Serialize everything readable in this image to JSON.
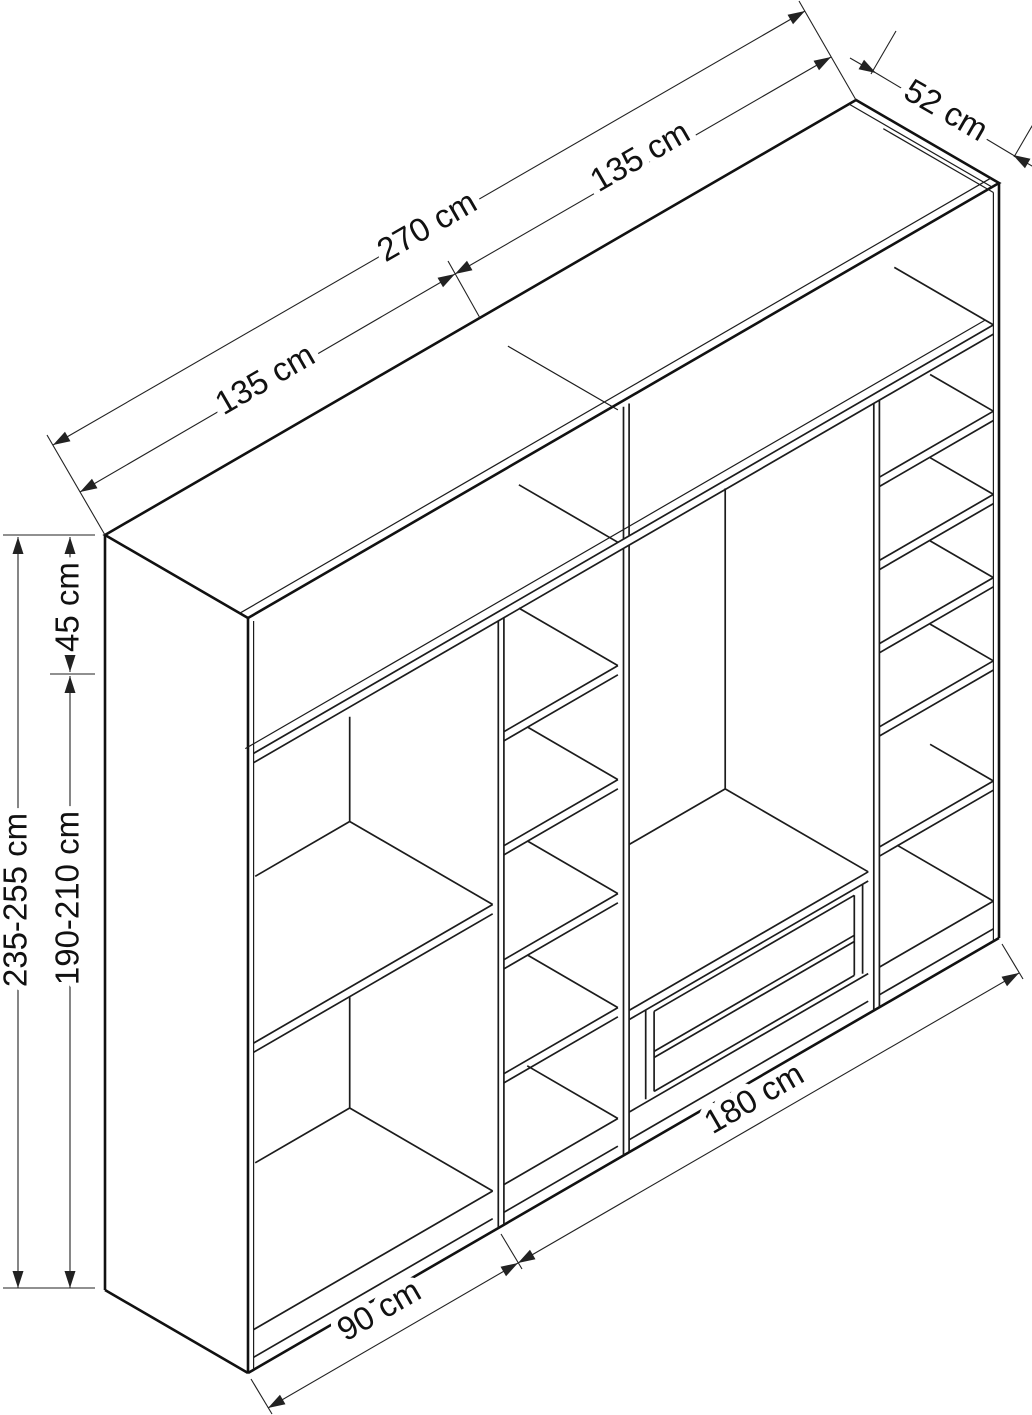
{
  "page": {
    "background_color": "#ffffff",
    "line_color": "#111111",
    "description": "Isometric technical drawing of a wardrobe with open shelves and drawers, annotated with dimension lines"
  },
  "diagram": {
    "type": "isometric-furniture-dimension-drawing",
    "unit": "cm",
    "dimensions": {
      "width_total": {
        "label": "270 cm",
        "value": "270"
      },
      "width_left_half": {
        "label": "135 cm",
        "value": "135"
      },
      "width_right_half": {
        "label": "135 cm",
        "value": "135"
      },
      "depth": {
        "label": "52 cm",
        "value": "52"
      },
      "top_section_height": {
        "label": "45 cm",
        "value": "45"
      },
      "height_total": {
        "label": "235-255 cm",
        "value": "235-255"
      },
      "height_lower": {
        "label": "190-210 cm",
        "value": "190-210"
      },
      "bottom_left_width": {
        "label": "90 cm",
        "value": "90"
      },
      "bottom_right_width": {
        "label": "180 cm",
        "value": "180"
      }
    }
  }
}
